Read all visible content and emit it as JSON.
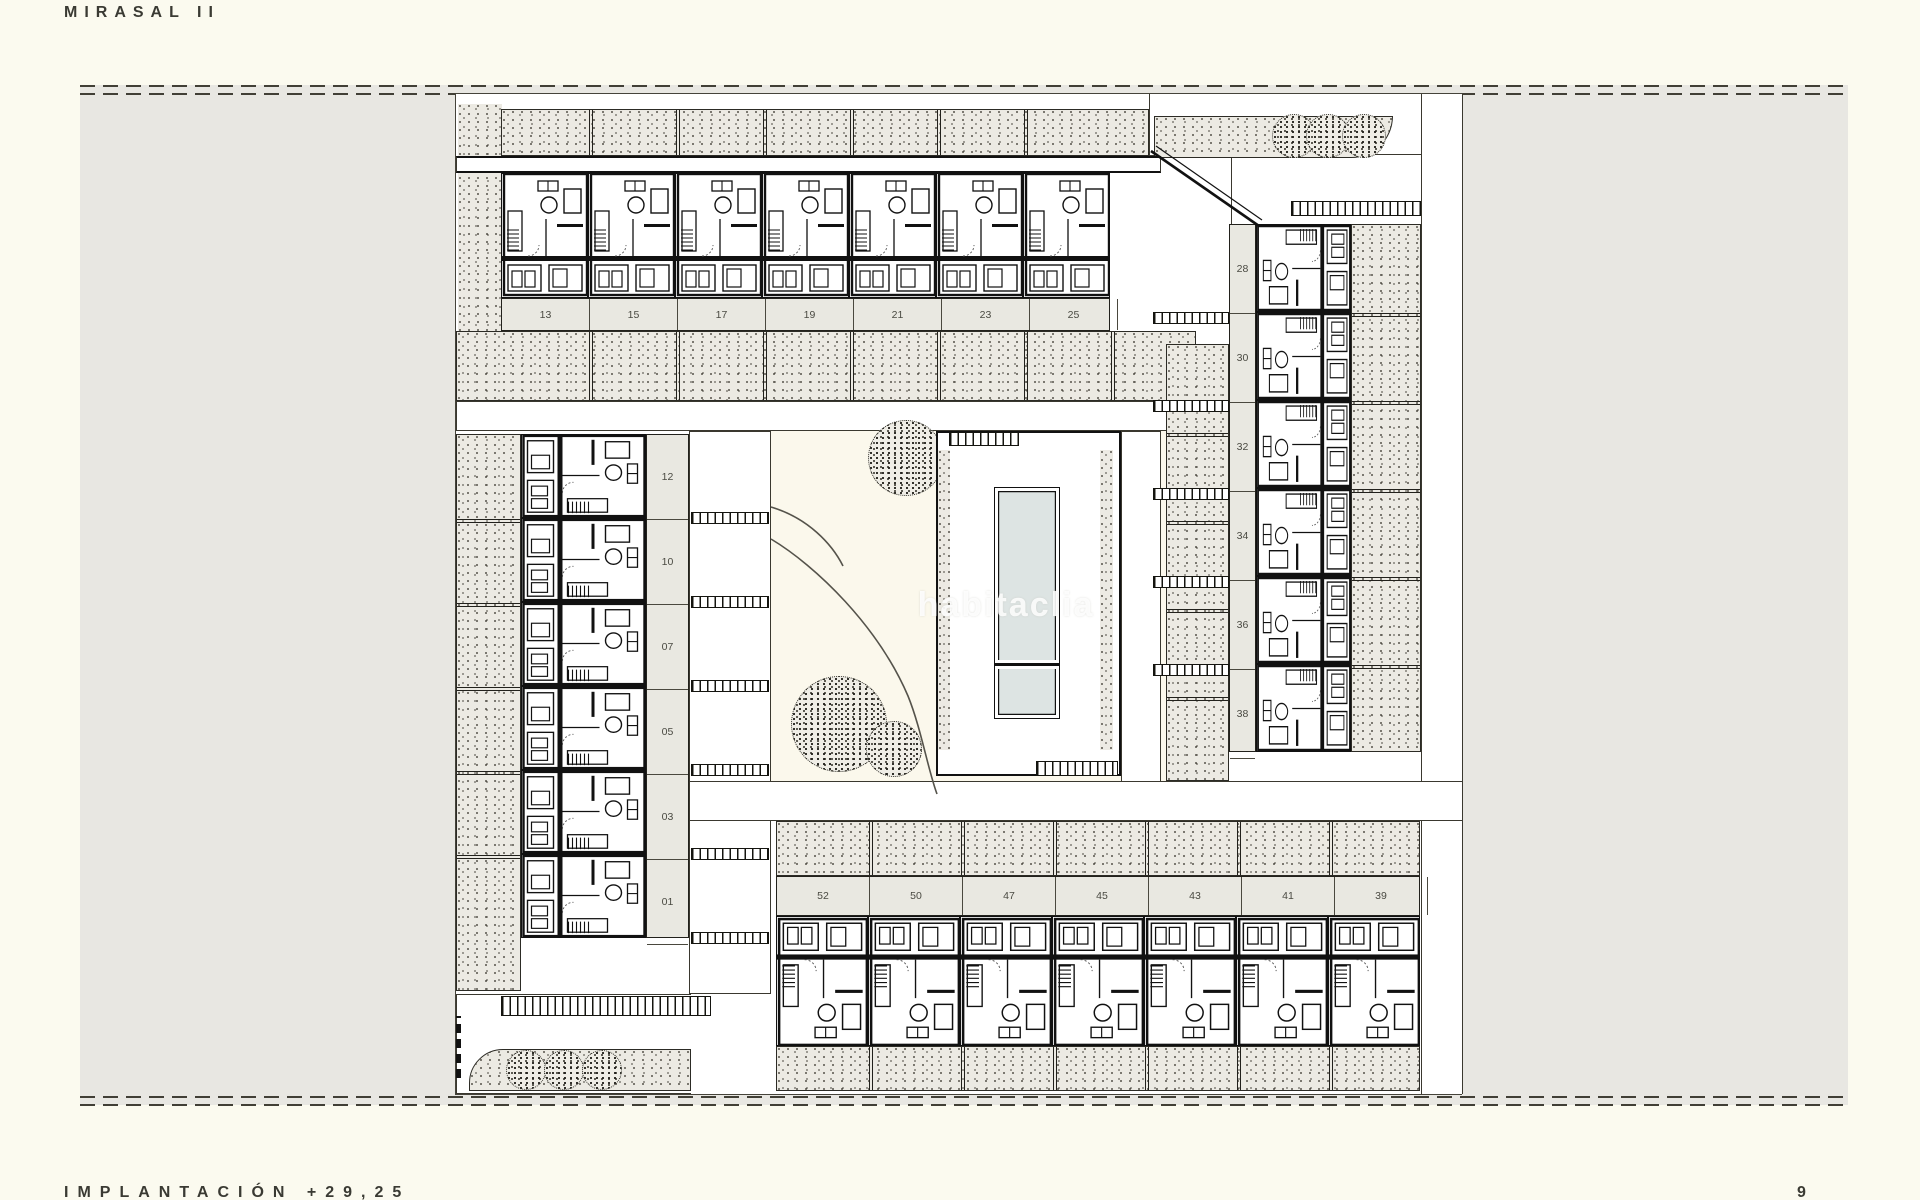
{
  "sheet": {
    "title": "MIRASAL II",
    "caption": "IMPLANTACIÓN +29,25",
    "page_number": "9"
  },
  "watermark": {
    "text": "habitaclia"
  },
  "site_plan": {
    "blocks": {
      "top_row": {
        "unit_numbers": [
          "13",
          "15",
          "17",
          "19",
          "21",
          "23",
          "25"
        ]
      },
      "left_column": {
        "unit_numbers": [
          "12",
          "10",
          "07",
          "05",
          "03",
          "01"
        ]
      },
      "right_column": {
        "unit_numbers": [
          "28",
          "30",
          "32",
          "34",
          "36",
          "38"
        ]
      },
      "bottom_row": {
        "unit_numbers": [
          "52",
          "50",
          "47",
          "45",
          "43",
          "41",
          "39"
        ]
      }
    },
    "features": {
      "pool": "rectangular pool with small splash section",
      "tree_count": 9
    },
    "colors": {
      "pool_water": "#dde4e3",
      "paper": "#fbfaef",
      "field_gray": "#e8e7e2"
    }
  }
}
